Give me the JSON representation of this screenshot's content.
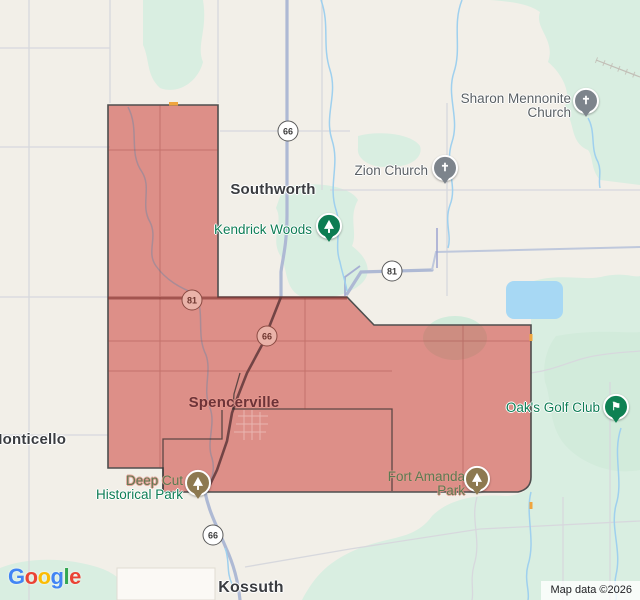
{
  "app": {
    "name": "google-maps-embed"
  },
  "attribution": {
    "text": "Map data ©2026"
  },
  "logo": {
    "letters": [
      {
        "ch": "G",
        "color": "#4285F4"
      },
      {
        "ch": "o",
        "color": "#EA4335"
      },
      {
        "ch": "o",
        "color": "#FBBC05"
      },
      {
        "ch": "g",
        "color": "#4285F4"
      },
      {
        "ch": "l",
        "color": "#34A853"
      },
      {
        "ch": "e",
        "color": "#EA4335"
      }
    ]
  },
  "colors": {
    "land": "#f2efe8",
    "parkland": "#d9eee1",
    "parkland_light": "#d2ebdb",
    "water": "#a7d8f4",
    "road_grid": "#d7d8dd",
    "road_major": "#aeb9d4",
    "stream": "#9fd0ee",
    "region_fill": "rgba(200,48,40,0.5)",
    "region_border": "#4e4e4e"
  },
  "region": {
    "label": "spencerville-highlighted-boundary"
  },
  "labels": [
    {
      "id": "sharon-mennonite-church",
      "x": 571,
      "y": 92,
      "align": "right",
      "lines": [
        {
          "text": "Sharon Mennonite",
          "cls": "church"
        },
        {
          "text": "Church",
          "cls": "church"
        }
      ]
    },
    {
      "id": "zion-church",
      "x": 428,
      "y": 164,
      "align": "right",
      "lines": [
        {
          "text": "Zion Church",
          "cls": "church"
        }
      ]
    },
    {
      "id": "southworth",
      "x": 273,
      "y": 181,
      "align": "center",
      "lines": [
        {
          "text": "Southworth",
          "cls": "town"
        }
      ]
    },
    {
      "id": "kendrick-woods",
      "x": 312,
      "y": 223,
      "align": "right",
      "lines": [
        {
          "text": "Kendrick Woods",
          "cls": "poi"
        }
      ]
    },
    {
      "id": "spencerville",
      "x": 234,
      "y": 394,
      "align": "center",
      "lines": [
        {
          "text": "Spencerville",
          "cls": "town-tinted"
        }
      ]
    },
    {
      "id": "monticello",
      "x": 28,
      "y": 431,
      "align": "center",
      "lines": [
        {
          "text": "Monticello",
          "cls": "town"
        }
      ]
    },
    {
      "id": "deep-cut-historical-park",
      "x": 183,
      "y": 474,
      "align": "right",
      "lines": [
        {
          "text": "Deep Cut",
          "cls": "poi-tinted"
        },
        {
          "text": "Historical Park",
          "cls": "poi"
        }
      ]
    },
    {
      "id": "fort-amanda-park",
      "x": 465,
      "y": 470,
      "align": "right",
      "lines": [
        {
          "text": "Fort Amanda",
          "cls": "poi-tinted"
        },
        {
          "text": "Park",
          "cls": "poi-tinted"
        }
      ]
    },
    {
      "id": "oaks-golf-club",
      "x": 600,
      "y": 401,
      "align": "right",
      "lines": [
        {
          "text": "Oak's Golf Club",
          "cls": "poi"
        }
      ]
    },
    {
      "id": "kossuth",
      "x": 251,
      "y": 579,
      "align": "center",
      "lines": [
        {
          "text": "Kossuth",
          "cls": "town town-big"
        }
      ]
    }
  ],
  "pins": [
    {
      "type": "church",
      "x": 586,
      "y": 103,
      "tinted": false
    },
    {
      "type": "church",
      "x": 445,
      "y": 170,
      "tinted": false
    },
    {
      "type": "tree",
      "x": 329,
      "y": 228,
      "tinted": false
    },
    {
      "type": "tree",
      "x": 198,
      "y": 485,
      "tinted": true
    },
    {
      "type": "tree",
      "x": 477,
      "y": 481,
      "tinted": true
    },
    {
      "type": "golf",
      "x": 616,
      "y": 409,
      "tinted": false
    }
  ],
  "shields": [
    {
      "num": "66",
      "x": 288,
      "y": 131,
      "tinted": false
    },
    {
      "num": "81",
      "x": 392,
      "y": 271,
      "tinted": false
    },
    {
      "num": "81",
      "x": 192,
      "y": 300,
      "tinted": true
    },
    {
      "num": "66",
      "x": 267,
      "y": 336,
      "tinted": true
    },
    {
      "num": "66",
      "x": 213,
      "y": 535,
      "tinted": false
    }
  ]
}
